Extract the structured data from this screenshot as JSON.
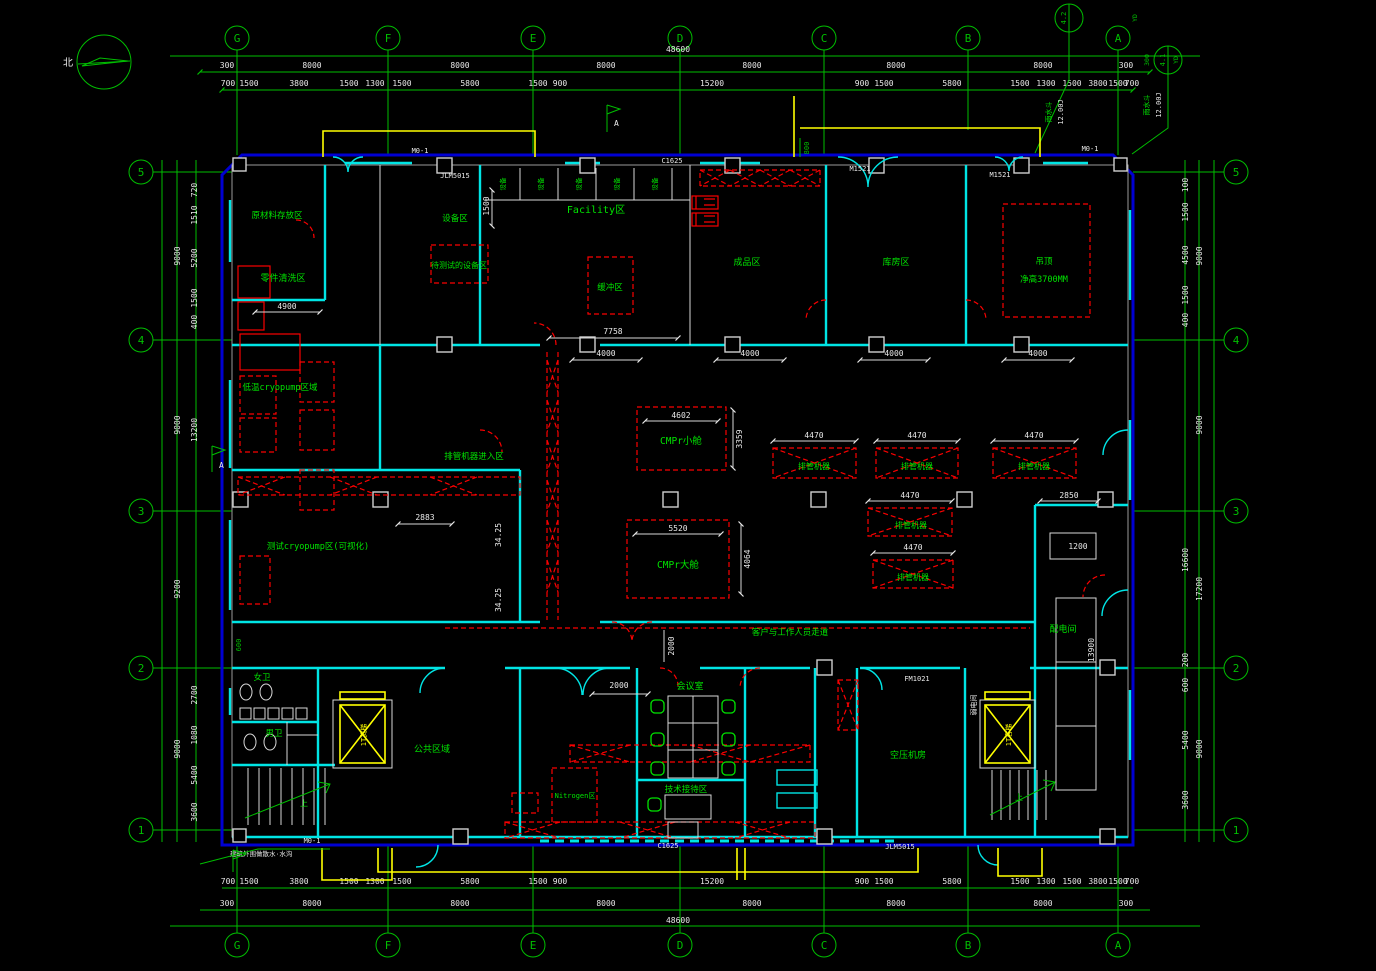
{
  "north": "北",
  "cols": [
    "G",
    "F",
    "E",
    "D",
    "C",
    "B",
    "A"
  ],
  "rows": [
    "5",
    "4",
    "3",
    "2",
    "1"
  ],
  "dim": {
    "overall": "48600",
    "e300": "300",
    "s8000": "8000",
    "ts": [
      "700",
      "1500",
      "3800",
      "1500",
      "1300",
      "1500",
      "5800",
      "1500",
      "900",
      "15200",
      "900",
      "1500",
      "5800",
      "1500",
      "1300",
      "1500",
      "3800",
      "1500",
      "700"
    ],
    "lm": [
      "9000",
      "9000",
      "9200",
      "9000"
    ],
    "ls": [
      "720",
      "1510",
      "5200",
      "1500",
      "400",
      "13200",
      "2700",
      "1080",
      "5400",
      "3600"
    ],
    "rm": [
      "9000",
      "9000",
      "17200",
      "9000"
    ],
    "rs": [
      "100",
      "1500",
      "4500",
      "1500",
      "400",
      "16600",
      "200",
      "600",
      "5400",
      "3600"
    ],
    "d4900": "4900",
    "d7758": "7758",
    "d4000": "4000",
    "d1500": "1500",
    "d800": "800",
    "d600": "600",
    "d2000": "2000",
    "d4602": "4602",
    "d3359": "3359",
    "d5520": "5520",
    "d4064": "4064",
    "d4470": "4470",
    "d2850": "2850",
    "d2883": "2883",
    "d3425": "34.25",
    "d13900": "13900",
    "d1200": "1200",
    "d12001": "12.00J",
    "d300": "300"
  },
  "rooms": {
    "raw_material": "原材料存放区",
    "parts_clean": "零件清洗区",
    "equipment": "设备区",
    "pending_test": "待测试的设备区",
    "facility": "Facility区",
    "buffer": "缓冲区",
    "finished": "成品区",
    "storage": "库房区",
    "ceiling_l1": "吊顶",
    "ceiling_l2": "净高3700MM",
    "cryo_low": "低温cryopump区域",
    "cryo_test": "测试cryopump区(可视化)",
    "pipe_entry": "排管机器进入区",
    "cmpr_small": "CMPr小舱",
    "cmpr_big": "CMPr大舱",
    "pipe_machine": "排管机器",
    "power_room": "配电间",
    "weak_room": "弱电间",
    "corridor": "客户与工作人员走道",
    "meeting": "会议室",
    "reception": "技术接待区",
    "public": "公共区域",
    "air_comp": "空压机房",
    "nitrogen": "Nitrogen区",
    "wc_w": "女卫",
    "wc_m": "男卫",
    "elev_cargo": "1T货梯",
    "elev_pass": "1T客梯",
    "equip_cell": "设备",
    "up": "上"
  },
  "tags": {
    "m01": "M0-1",
    "m1521": "M1521",
    "c1625": "C1625",
    "jlm": "JLM5015",
    "fm": "FM1021",
    "sec": "A"
  },
  "call": {
    "a_top": "4.2",
    "a_bot": "YD",
    "a_note": "雨水斗",
    "b_top": "4.1",
    "b_bot": "YD",
    "b_note": "雨水斗"
  },
  "notes": {
    "splash": "建筑外围做散水·水沟"
  }
}
